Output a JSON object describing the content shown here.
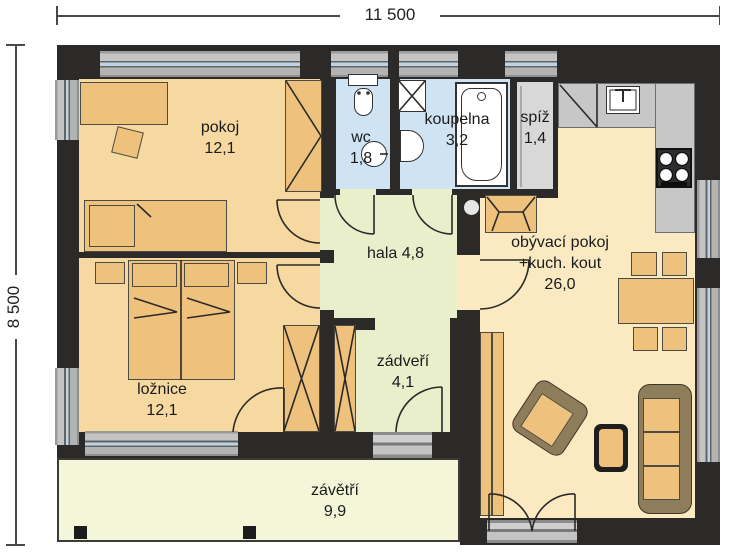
{
  "dimensions": {
    "width_label": "11 500",
    "height_label": "8 500"
  },
  "rooms": {
    "pokoj": {
      "name": "pokoj",
      "area": "12,1"
    },
    "wc": {
      "name": "wc",
      "area": "1,8"
    },
    "koupelna": {
      "name": "koupelna",
      "area": "3,2"
    },
    "spiz": {
      "name": "spíž",
      "area": "1,4"
    },
    "hala": {
      "name": "hala",
      "area": "4,8"
    },
    "obyvaci": {
      "line1": "obývací pokoj",
      "line2": "+kuch. kout",
      "area": "26,0"
    },
    "loznice": {
      "name": "ložnice",
      "area": "12,1"
    },
    "zadveri": {
      "name": "zádveří",
      "area": "4,1"
    },
    "zavetri": {
      "name": "závětří",
      "area": "9,9"
    }
  },
  "icons": [
    "toilet-icon",
    "washbasin-icon",
    "washing-machine-icon",
    "bathtub-icon",
    "kitchen-sink-icon",
    "stove-icon",
    "fireplace-icon",
    "chimney-icon",
    "wardrobe-icon",
    "bed-icon",
    "sofa-icon",
    "armchair-icon",
    "dining-table-icon",
    "door-arc-icon",
    "window-icon",
    "column-post-icon"
  ],
  "colors": {
    "wall": "#2b2a28",
    "room_orange": "#f6d8a1",
    "furniture_orange": "#eec17c",
    "living_cream": "#fbe9c2",
    "hall_green": "#e9eecb",
    "porch_green": "#f3f6d8",
    "bath_blue": "#cfe3f2",
    "pantry_gray": "#d8d8d8",
    "counter_gray": "#c7c7c7",
    "window_glass_blue": "#bcd4e6",
    "sofa_brown": "#8e7d5b"
  }
}
